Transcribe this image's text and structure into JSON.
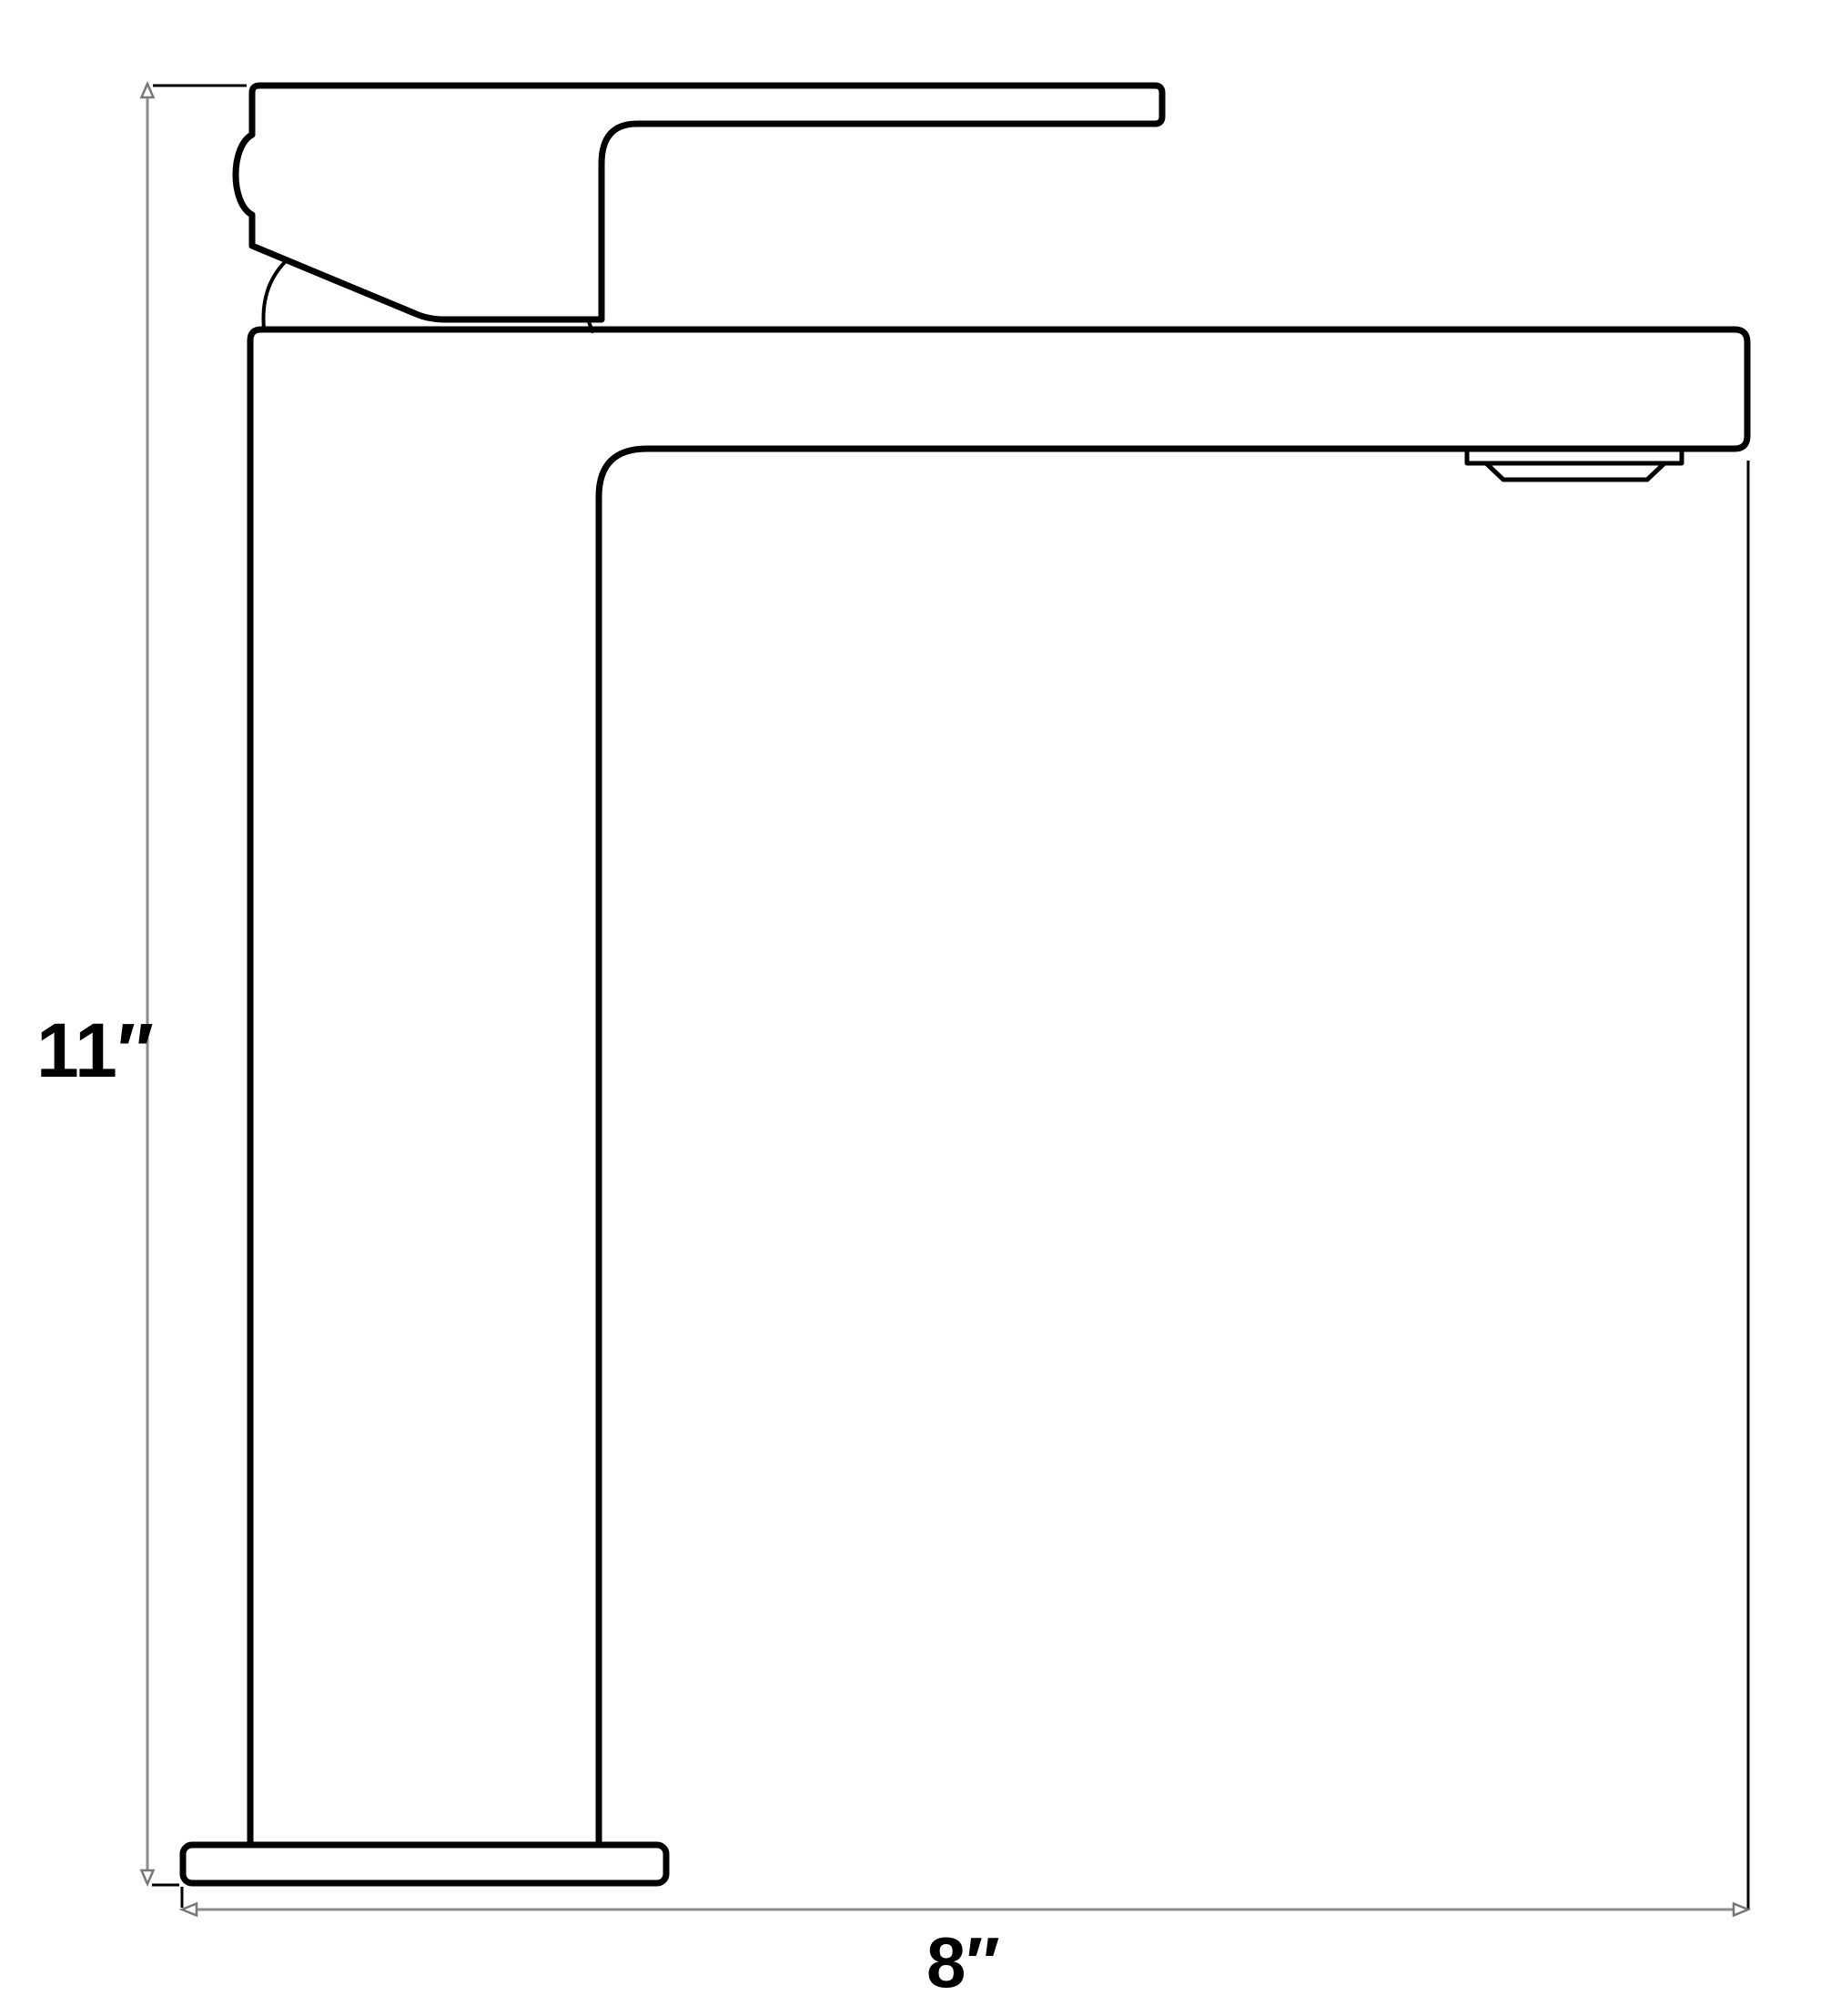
{
  "page": {
    "background": "#ffffff",
    "kind": "technical dimension drawing",
    "subject": "single-handle vessel faucet, side elevation"
  },
  "drawing": {
    "stroke_color": "#000000"
  },
  "dimensions": {
    "line_color": "#8c8c8c",
    "arrow_outline_color": "#777777",
    "height": {
      "label": "11″",
      "value_in": 11,
      "orientation": "vertical"
    },
    "width": {
      "label": "8″",
      "value_in": 8,
      "orientation": "horizontal"
    }
  }
}
